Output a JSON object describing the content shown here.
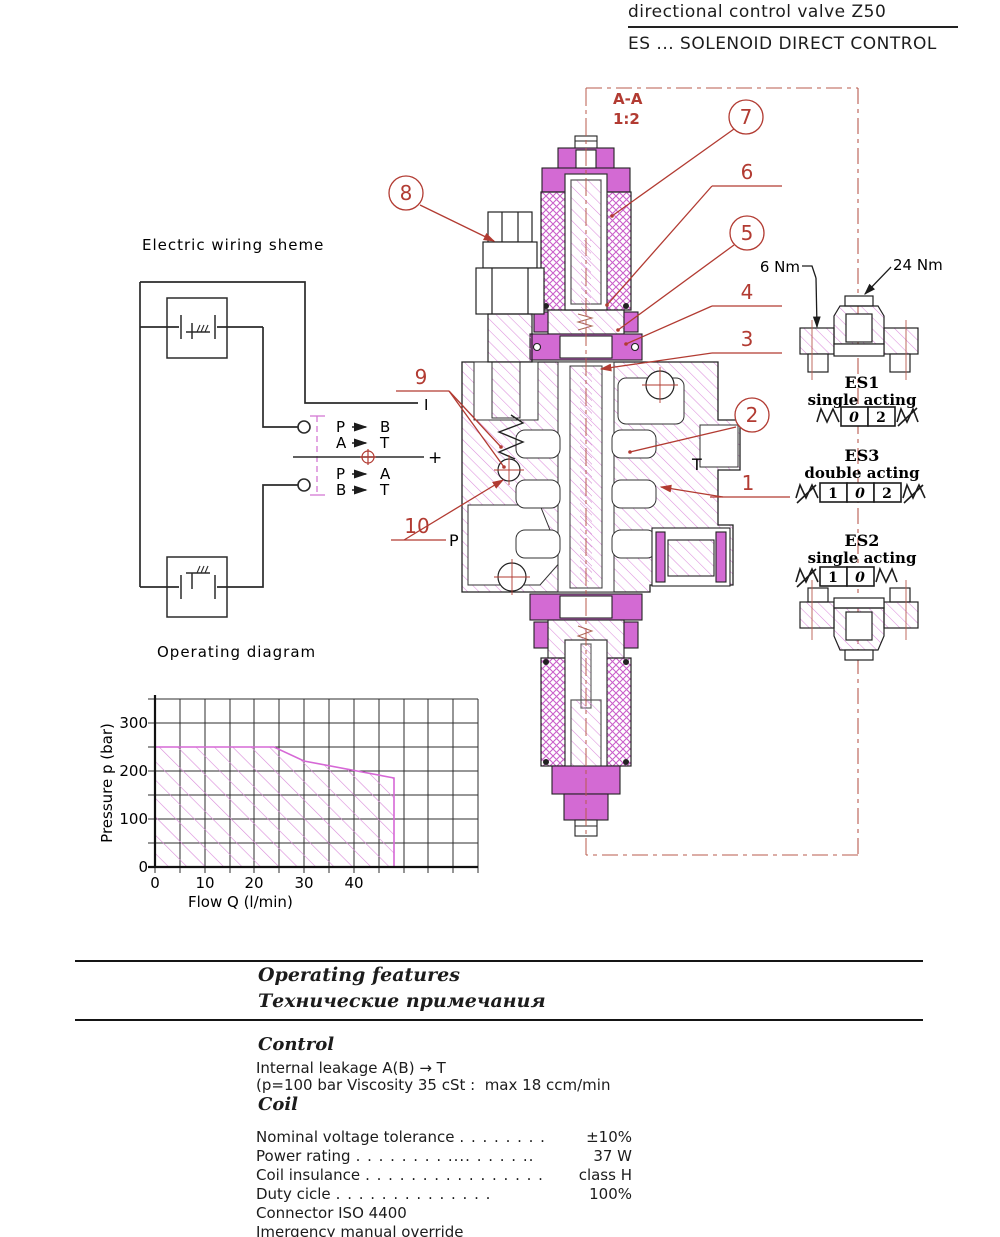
{
  "header": {
    "title": "directional control valve Z50",
    "subtitle": "ES ... SOLENOID DIRECT CONTROL"
  },
  "section": {
    "view_label": "A-A",
    "scale_label": "1:2",
    "port_p": "P",
    "port_t": "T"
  },
  "callouts": {
    "n1": "1",
    "n2": "2",
    "n3": "3",
    "n4": "4",
    "n5": "5",
    "n6": "6",
    "n7": "7",
    "n8": "8",
    "n9": "9",
    "n10": "10"
  },
  "torque": {
    "small": "6 Nm",
    "large": "24 Nm"
  },
  "variants": {
    "es1": {
      "name": "ES1",
      "mode": "single acting",
      "pos1": "0",
      "pos2": "2"
    },
    "es3": {
      "name": "ES3",
      "mode": "double acting",
      "pos1": "1",
      "pos2": "0",
      "pos3": "2"
    },
    "es2": {
      "name": "ES2",
      "mode": "single acting",
      "pos1": "1",
      "pos2": "0"
    }
  },
  "wiring": {
    "title": "Electric wiring sheme",
    "rows": [
      {
        "from": "P",
        "to": "B"
      },
      {
        "from": "A",
        "to": "T"
      },
      {
        "from": "P",
        "to": "A"
      },
      {
        "from": "B",
        "to": "T"
      }
    ],
    "plus": "+",
    "current": "I"
  },
  "chart_data": {
    "type": "area",
    "title": "Operating diagram",
    "xlabel": "Flow Q (l/min)",
    "ylabel": "Pressure p (bar)",
    "xlim": [
      0,
      65
    ],
    "ylim": [
      0,
      350
    ],
    "xticks": [
      "0",
      "10",
      "20",
      "30",
      "40"
    ],
    "yticks": [
      "0",
      "100",
      "200",
      "300"
    ],
    "grid": true,
    "minor_step": {
      "x": 5,
      "y": 50
    },
    "envelope_x_lmin": [
      0,
      24,
      30,
      48,
      48
    ],
    "envelope_y_bar": [
      250,
      250,
      220,
      185,
      0
    ],
    "fill_style": "magenta-hatch",
    "legend": "permitted operating area"
  },
  "features": {
    "heading_en": "Operating features",
    "heading_ru": "Технические примечания",
    "control": {
      "heading": "Control",
      "line1": "Internal leakage A(B) → T",
      "line2": "(p=100 bar Viscosity 35 cSt :  max 18 ccm/min"
    },
    "coil": {
      "heading": "Coil",
      "specs": [
        {
          "label": "Nominal voltage tolerance",
          "dots": ". . . . . . . .",
          "value": "±10%"
        },
        {
          "label": "Power rating",
          "dots": ". . . . . . . . .... . . . . ..",
          "value": "37 W"
        },
        {
          "label": "Coil insulance",
          "dots": ". . . . . . . . . . . . . . . .",
          "value": "class H"
        },
        {
          "label": "Duty cicle",
          "dots": ". . . . . . . . . . . . . .",
          "value": "100%"
        },
        {
          "label": "Connector ISO 4400",
          "dots": "",
          "value": ""
        },
        {
          "label": "Imergency manual override",
          "dots": "",
          "value": ""
        }
      ]
    }
  }
}
